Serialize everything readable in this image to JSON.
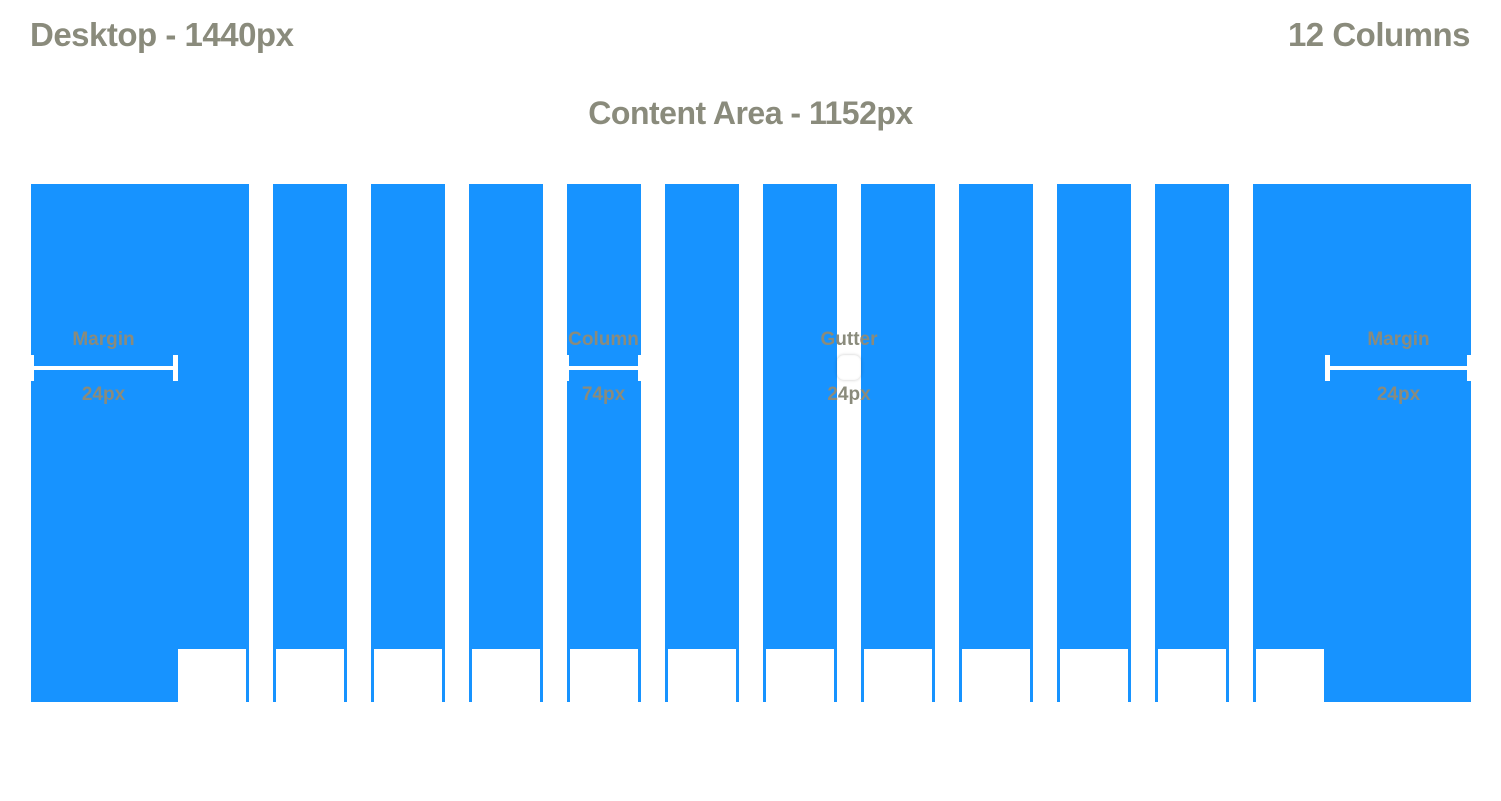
{
  "page": {
    "title": "Desktop - 1440px",
    "columns_count_label": "12 Columns",
    "content_area_label": "Content Area - 1152px"
  },
  "grid": {
    "column_count": 12,
    "colors": {
      "column_blue": "#1793FF",
      "label_gray": "#8A8B7C",
      "dimension_white": "#FFFFFF"
    }
  },
  "annotations": {
    "margin_left": {
      "label": "Margin",
      "value": "24px"
    },
    "column": {
      "label": "Column",
      "value": "74px"
    },
    "gutter": {
      "label": "Gutter",
      "value": "24px"
    },
    "margin_right": {
      "label": "Margin",
      "value": "24px"
    }
  }
}
